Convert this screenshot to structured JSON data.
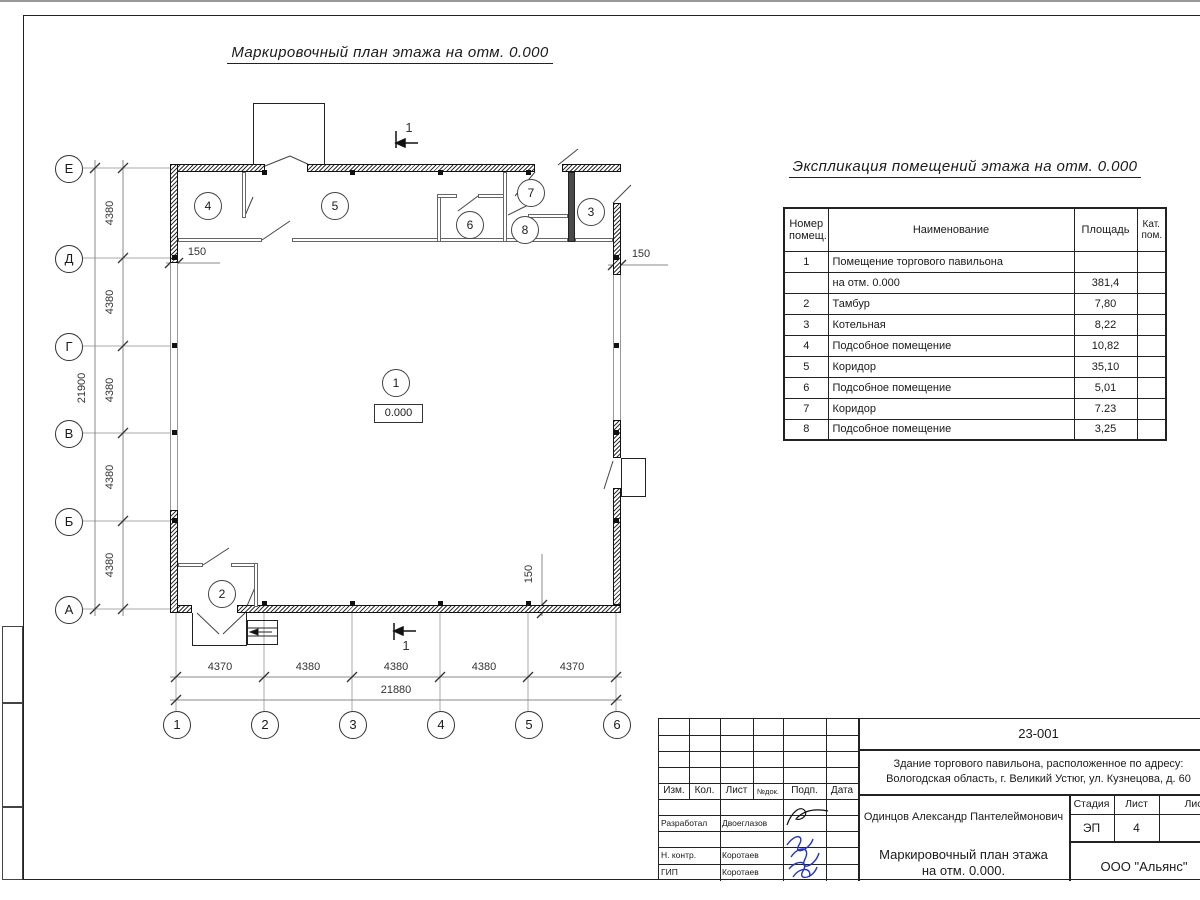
{
  "drawing": {
    "plan_title": "Маркировочный план этажа на отм. 0.000",
    "level_mark": "0.000",
    "section_label": "1",
    "wall_thickness_dim": "150",
    "axes_rows": [
      "Е",
      "Д",
      "Г",
      "В",
      "Б",
      "А"
    ],
    "axes_cols": [
      "1",
      "2",
      "3",
      "4",
      "5",
      "6"
    ],
    "row_dims": [
      "4380",
      "4380",
      "4380",
      "4380",
      "4380"
    ],
    "row_total": "21900",
    "col_dims": [
      "4370",
      "4380",
      "4380",
      "4380",
      "4370"
    ],
    "col_total": "21880",
    "rooms": [
      {
        "label": "1"
      },
      {
        "label": "2"
      },
      {
        "label": "3"
      },
      {
        "label": "4"
      },
      {
        "label": "5"
      },
      {
        "label": "6"
      },
      {
        "label": "7"
      },
      {
        "label": "8"
      }
    ]
  },
  "explication": {
    "title": "Экспликация помещений этажа на отм. 0.000",
    "headers": {
      "number": "Номер\nпомещ.",
      "name": "Наименование",
      "area": "Площадь",
      "cat": "Кат.\nпом."
    },
    "rows": [
      {
        "num": "1",
        "name": "Помещение торгового павильона",
        "area": "",
        "cat": ""
      },
      {
        "num": "",
        "name": "на отм. 0.000",
        "area": "381,4",
        "cat": ""
      },
      {
        "num": "2",
        "name": "Тамбур",
        "area": "7,80",
        "cat": ""
      },
      {
        "num": "3",
        "name": "Котельная",
        "area": "8,22",
        "cat": ""
      },
      {
        "num": "4",
        "name": "Подсобное помещение",
        "area": "10,82",
        "cat": ""
      },
      {
        "num": "5",
        "name": "Коридор",
        "area": "35,10",
        "cat": ""
      },
      {
        "num": "6",
        "name": "Подсобное помещение",
        "area": "5,01",
        "cat": ""
      },
      {
        "num": "7",
        "name": "Коридор",
        "area": "7.23",
        "cat": ""
      },
      {
        "num": "8",
        "name": "Подсобное помещение",
        "area": "3,25",
        "cat": ""
      }
    ]
  },
  "titleblock": {
    "doc_number": "23-001",
    "project_name": "Здание торгового павильона, расположенное по адресу:\nВологодская область, г. Великий Устюг, ул. Кузнецова, д. 60",
    "col_headers": {
      "izm": "Изм.",
      "kol": "Кол.",
      "list": "Лист",
      "ndok": "№док.",
      "podp": "Подп.",
      "data": "Дата"
    },
    "rows": [
      {
        "role": "Разработал",
        "name": "Двоеглазов"
      },
      {
        "role": "Н. контр.",
        "name": "Коротаев"
      },
      {
        "role": "ГИП",
        "name": "Коротаев"
      }
    ],
    "client": "Одинцов Александр Пантелеймонович",
    "stage_header": "Стадия",
    "sheet_header": "Лист",
    "sheets_header": "Листов",
    "stage": "ЭП",
    "sheet_number": "4",
    "sheet_title": "Маркировочный план этажа\nна отм. 0.000.",
    "organization": "ООО \"Альянс\""
  },
  "colors": {
    "signature_blue": "#2233cc",
    "line_black": "#1a1a1a",
    "line_gray": "#999999"
  }
}
